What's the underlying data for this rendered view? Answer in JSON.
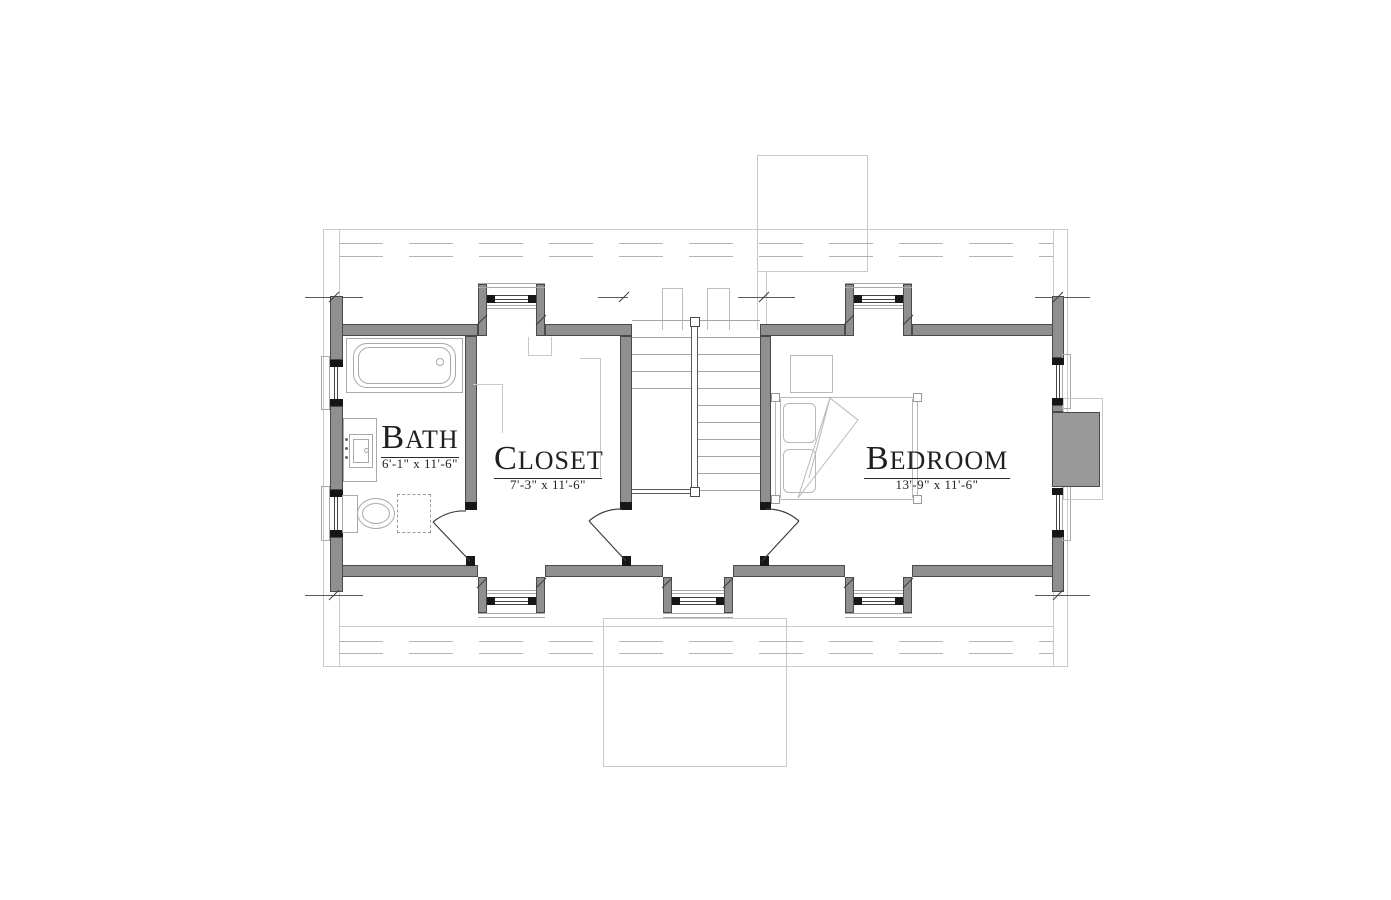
{
  "rooms": [
    {
      "id": "bath",
      "label": "BATH",
      "dimensions": "6'-1\" x 11'-6\""
    },
    {
      "id": "closet",
      "label": "CLOSET",
      "dimensions": "7'-3\" x 11'-6\""
    },
    {
      "id": "bedroom",
      "label": "BEDROOM",
      "dimensions": "13'-9\" x 11'-6\""
    }
  ],
  "fixtures": [
    "bathtub",
    "vanity-sink",
    "toilet",
    "linen-access-dashed",
    "staircase",
    "stair-railing",
    "bed",
    "pillows",
    "nightstand",
    "chimney",
    "dormer-window",
    "double-hung-window",
    "door-swing",
    "roof-overhang-outline"
  ],
  "colors": {
    "wall_fill": "#8f8f8f",
    "wall_edge": "#4a4a4a",
    "black_detail": "#161616",
    "fixture_line": "#a9a9a9",
    "faint_line": "#c9c9c9",
    "text": "#1f1f1f"
  }
}
